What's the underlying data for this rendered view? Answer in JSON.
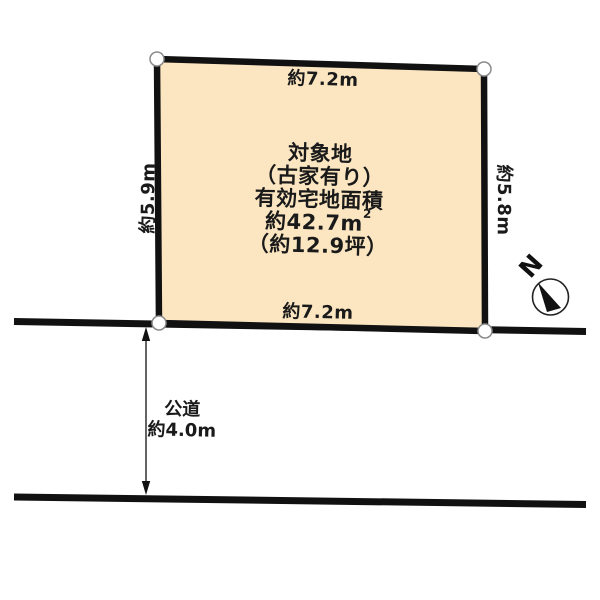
{
  "plot": {
    "name_line": "対象地",
    "note_line": "（古家有り）",
    "area_label": "有効宅地面積",
    "area_value": "約42.7m",
    "area_superscript": "2",
    "area_tsubo": "（約12.9坪）",
    "dim_top": "約7.2m",
    "dim_bottom": "約7.2m",
    "dim_left": "約5.9m",
    "dim_right": "約5.8m"
  },
  "road": {
    "name": "公道",
    "width_value": "約4.0m"
  },
  "compass": {
    "north_label": "N"
  },
  "colors": {
    "plot_fill": "#FBE6C1",
    "line": "#111111",
    "text": "#1A1A1A"
  }
}
